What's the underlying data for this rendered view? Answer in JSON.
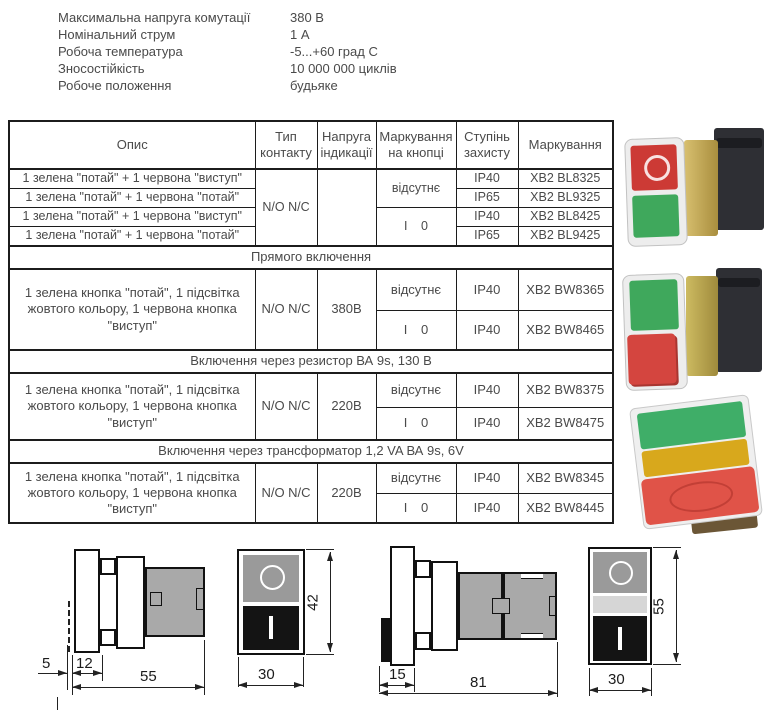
{
  "specs": {
    "items": [
      {
        "label": "Максимальна напруга комутації",
        "value": "380 В"
      },
      {
        "label": "Номінальний струм",
        "value": "1 А"
      },
      {
        "label": "Робоча температура",
        "value": "-5...+60 град С"
      },
      {
        "label": "Зносостійкість",
        "value": "10 000 000 циклів"
      },
      {
        "label": "Робоче положення",
        "value": "будьяке"
      }
    ]
  },
  "table": {
    "headers": {
      "desc": "Опис",
      "contact": "Тип контакту",
      "voltage": "Напруга індикації",
      "marking_btn": "Маркування на кнопці",
      "ip": "Ступінь захисту",
      "marking": "Маркування"
    },
    "group1": {
      "contact": "N/O N/C",
      "voltage": "",
      "marking_none": "відсутнє",
      "marking_io": "І 0",
      "rows": [
        {
          "desc": "1 зелена \"потай\" + 1 червона \"виступ\"",
          "ip": "IP40",
          "code": "XB2 BL8325"
        },
        {
          "desc": "1 зелена \"потай\" + 1 червона \"потай\"",
          "ip": "IP65",
          "code": "XB2 BL9325"
        },
        {
          "desc": "1 зелена \"потай\" + 1 червона \"виступ\"",
          "ip": "IP40",
          "code": "XB2 BL8425"
        },
        {
          "desc": "1 зелена \"потай\" + 1 червона \"потай\"",
          "ip": "IP65",
          "code": "XB2 BL9425"
        }
      ]
    },
    "sections": [
      {
        "title": "Прямого включення",
        "desc": "1 зелена кнопка \"потай\", 1 підсвітка жовтого кольору, 1 червона кнопка \"виступ\"",
        "contact": "N/O N/C",
        "voltage": "380В",
        "rows": [
          {
            "marking": "відсутнє",
            "ip": "IP40",
            "code": "XB2 BW8365"
          },
          {
            "marking": "І 0",
            "ip": "IP40",
            "code": "XB2 BW8465"
          }
        ]
      },
      {
        "title": "Включення через резистор ВА 9s, 130 В",
        "desc": "1 зелена кнопка \"потай\", 1 підсвітка жовтого кольору, 1 червона кнопка \"виступ\"",
        "contact": "N/O N/C",
        "voltage": "220В",
        "rows": [
          {
            "marking": "відсутнє",
            "ip": "IP40",
            "code": "XB2 BW8375"
          },
          {
            "marking": "І 0",
            "ip": "IP40",
            "code": "XB2 BW8475"
          }
        ]
      },
      {
        "title": "Включення через трансформатор 1,2 VA ВА 9s, 6V",
        "desc": "1 зелена кнопка \"потай\", 1 підсвітка жовтого кольору, 1 червона кнопка \"виступ\"",
        "contact": "N/O N/C",
        "voltage": "220В",
        "rows": [
          {
            "marking": "відсутнє",
            "ip": "IP40",
            "code": "XB2 BW8345"
          },
          {
            "marking": "І 0",
            "ip": "IP40",
            "code": "XB2 BW8445"
          }
        ]
      }
    ]
  },
  "drawings": {
    "side_small": {
      "dim_front": "5",
      "dim_bezel": "12",
      "dim_depth": "55"
    },
    "front_small": {
      "dim_width": "30",
      "dim_height": "42"
    },
    "side_large": {
      "dim_front": "15",
      "dim_depth": "81"
    },
    "front_large": {
      "dim_width": "30",
      "dim_height": "55"
    },
    "symbols": {
      "stop": "O",
      "start": "I"
    }
  },
  "colors": {
    "red": "#cc3a35",
    "green": "#3fa85c",
    "yellow": "#d8a81c",
    "brass": "#bb9c4c",
    "drawing_gray": "#a9a9a9",
    "text": "#4a4a4a"
  }
}
